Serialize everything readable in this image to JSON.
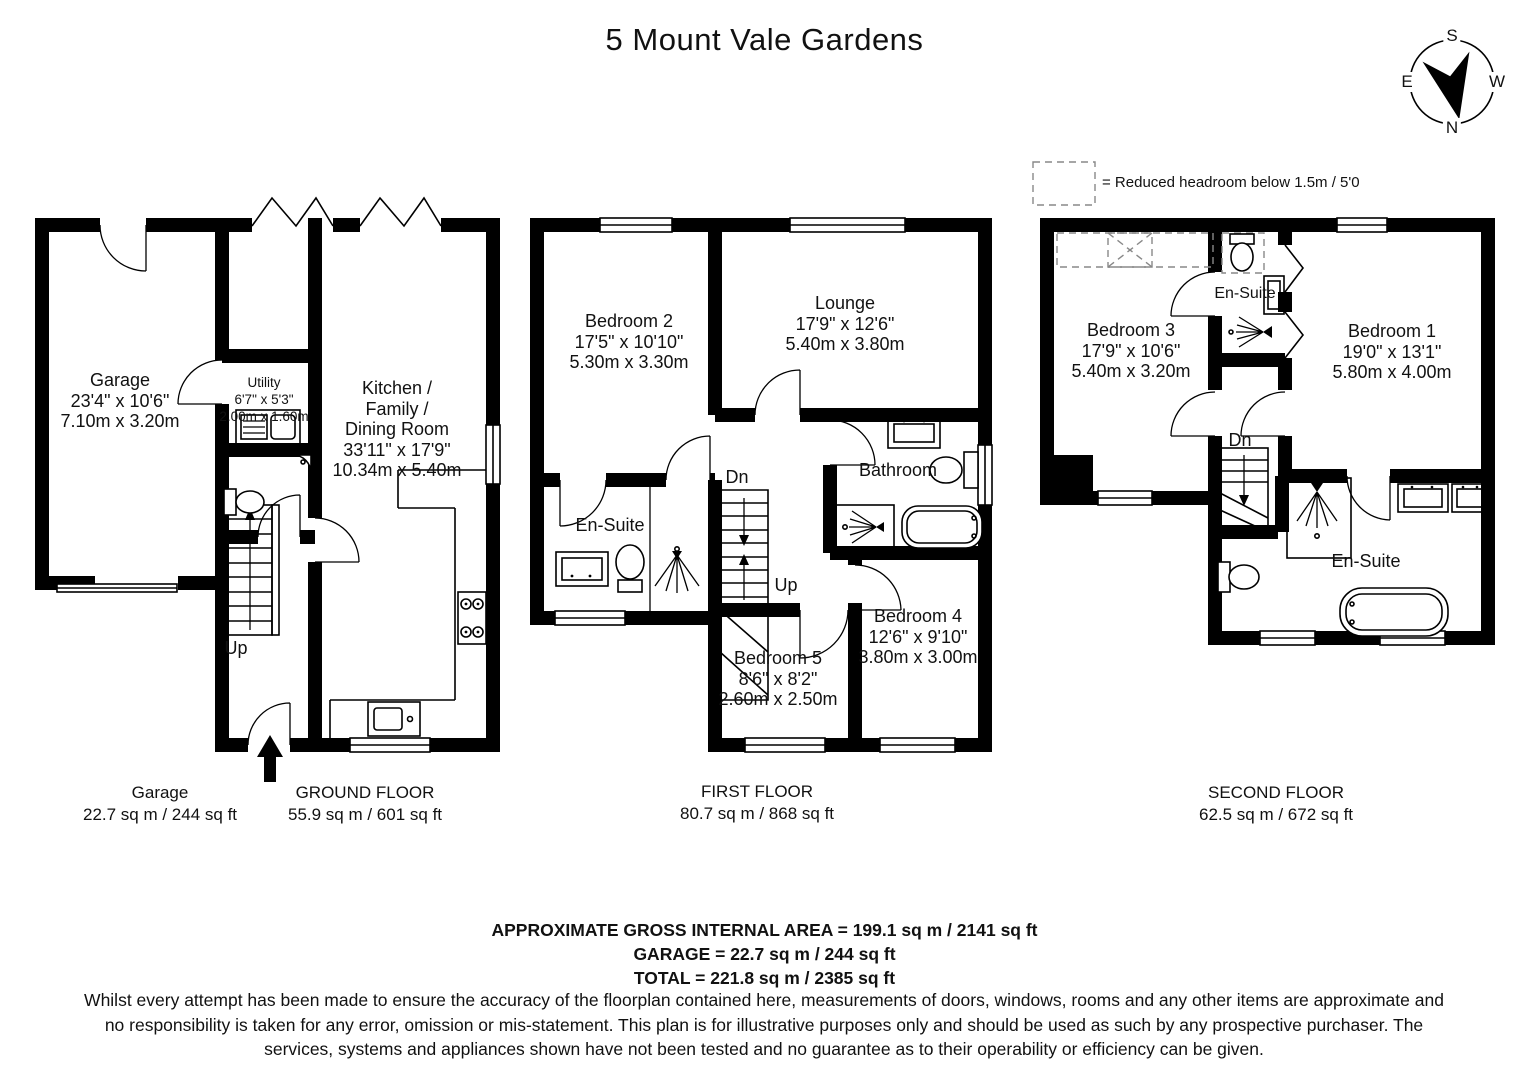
{
  "title": "5 Mount Vale Gardens",
  "compass": {
    "top": "S",
    "bottom": "N",
    "left": "E",
    "right": "W"
  },
  "legend": "= Reduced headroom below 1.5m / 5'0",
  "rooms": {
    "garage": {
      "name": "Garage",
      "imperial": "23'4\" x 10'6\"",
      "metric": "7.10m x 3.20m"
    },
    "utility": {
      "name": "Utility",
      "imperial": "6'7\" x 5'3\"",
      "metric": "2.00m x 1.60m"
    },
    "kitchen": {
      "name": "Kitchen /\nFamily /\nDining Room",
      "imperial": "33'11\" x 17'9\"",
      "metric": "10.34m x 5.40m"
    },
    "bedroom2": {
      "name": "Bedroom 2",
      "imperial": "17'5\" x 10'10\"",
      "metric": "5.30m x 3.30m"
    },
    "lounge": {
      "name": "Lounge",
      "imperial": "17'9\" x 12'6\"",
      "metric": "5.40m x 3.80m"
    },
    "ensuite_first": {
      "name": "En-Suite"
    },
    "bathroom": {
      "name": "Bathroom"
    },
    "bedroom5": {
      "name": "Bedroom 5",
      "imperial": "8'6\" x 8'2\"",
      "metric": "2.60m x 2.50m"
    },
    "bedroom4": {
      "name": "Bedroom 4",
      "imperial": "12'6\" x 9'10\"",
      "metric": "3.80m x 3.00m"
    },
    "bedroom3": {
      "name": "Bedroom 3",
      "imperial": "17'9\" x 10'6\"",
      "metric": "5.40m x 3.20m"
    },
    "ensuite_second_small": {
      "name": "En-Suite"
    },
    "bedroom1": {
      "name": "Bedroom 1",
      "imperial": "19'0\" x 13'1\"",
      "metric": "5.80m x 4.00m"
    },
    "ensuite_second_main": {
      "name": "En-Suite"
    }
  },
  "stairs": {
    "ground_up": "Up",
    "first_down": "Dn",
    "first_up": "Up",
    "second_down": "Dn"
  },
  "captions": {
    "garage": {
      "title": "Garage",
      "area": "22.7 sq m / 244 sq ft"
    },
    "ground": {
      "title": "GROUND FLOOR",
      "area": "55.9 sq m / 601 sq ft"
    },
    "first": {
      "title": "FIRST FLOOR",
      "area": "80.7 sq m / 868 sq ft"
    },
    "second": {
      "title": "SECOND FLOOR",
      "area": "62.5 sq m / 672 sq ft"
    }
  },
  "summary": {
    "gross": "APPROXIMATE GROSS INTERNAL AREA = 199.1 sq m / 2141 sq ft",
    "garage": "GARAGE = 22.7 sq m / 244 sq ft",
    "total": "TOTAL = 221.8 sq m / 2385 sq ft"
  },
  "disclaimer": "Whilst every attempt has been made to ensure the accuracy of the floorplan contained here, measurements of doors, windows, rooms and any other items are approximate and no responsibility is taken for any error, omission or mis-statement. This plan is for illustrative purposes only and should be used as such by any prospective purchaser. The services, systems and appliances shown have not been tested and no guarantee as to their operability or efficiency can be given."
}
